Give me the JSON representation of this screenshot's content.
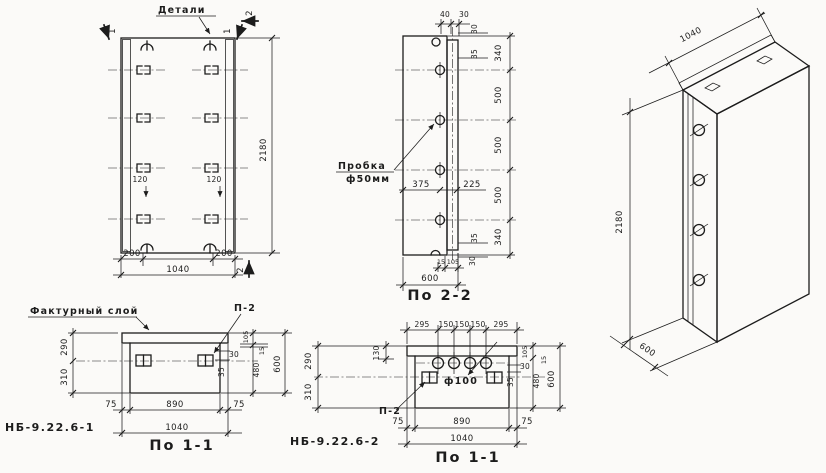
{
  "canvas": {
    "bg": "#fbfaf8",
    "ink": "#1c1c1c"
  },
  "front": {
    "details_label": "Детали",
    "cut1_left": "1",
    "cut1_right": "1",
    "cut2_top": "2",
    "cut2_bottom": "2",
    "height": "2180",
    "width_total": "1040",
    "edge_left": "200",
    "edge_right": "200",
    "anchor_offset_left": "120",
    "anchor_offset_right": "120"
  },
  "side": {
    "caption": "По 2-2",
    "plug_line1": "Пробка",
    "plug_line2": "ф50мм",
    "top": [
      "40",
      "30"
    ],
    "edge_top": [
      "30",
      "35"
    ],
    "chain": [
      "340",
      "500",
      "500",
      "500",
      "340"
    ],
    "edge_bottom": [
      "35",
      "30"
    ],
    "foot": [
      "15",
      "105"
    ],
    "d375": "375",
    "d225": "225",
    "depth": "600"
  },
  "iso": {
    "width": "1040",
    "height": "2180",
    "depth": "600"
  },
  "sec1": {
    "mark": "НБ-9.22.6-1",
    "caption": "По 1-1",
    "facing_label": "Фактурный слой",
    "anchor_label": "П-2",
    "left": [
      "290",
      "310"
    ],
    "right": {
      "d105": "105",
      "d15": "15",
      "d480": "480",
      "d600": "600",
      "d30": "30",
      "d35": "35"
    },
    "bottom": [
      "75",
      "890",
      "75"
    ],
    "total": "1040"
  },
  "sec2": {
    "mark": "НБ-9.22.6-2",
    "caption": "По 1-1",
    "anchor_label": "П-2",
    "hole": "ф100",
    "top": [
      "295",
      "150",
      "150",
      "150",
      "295"
    ],
    "left": {
      "d130": "130",
      "d290": "290",
      "d310": "310"
    },
    "right": {
      "d30": "30",
      "d35": "35",
      "d105": "105",
      "d15": "15",
      "d480": "480",
      "d600": "600"
    },
    "bottom": [
      "75",
      "890",
      "75"
    ],
    "total": "1040"
  }
}
